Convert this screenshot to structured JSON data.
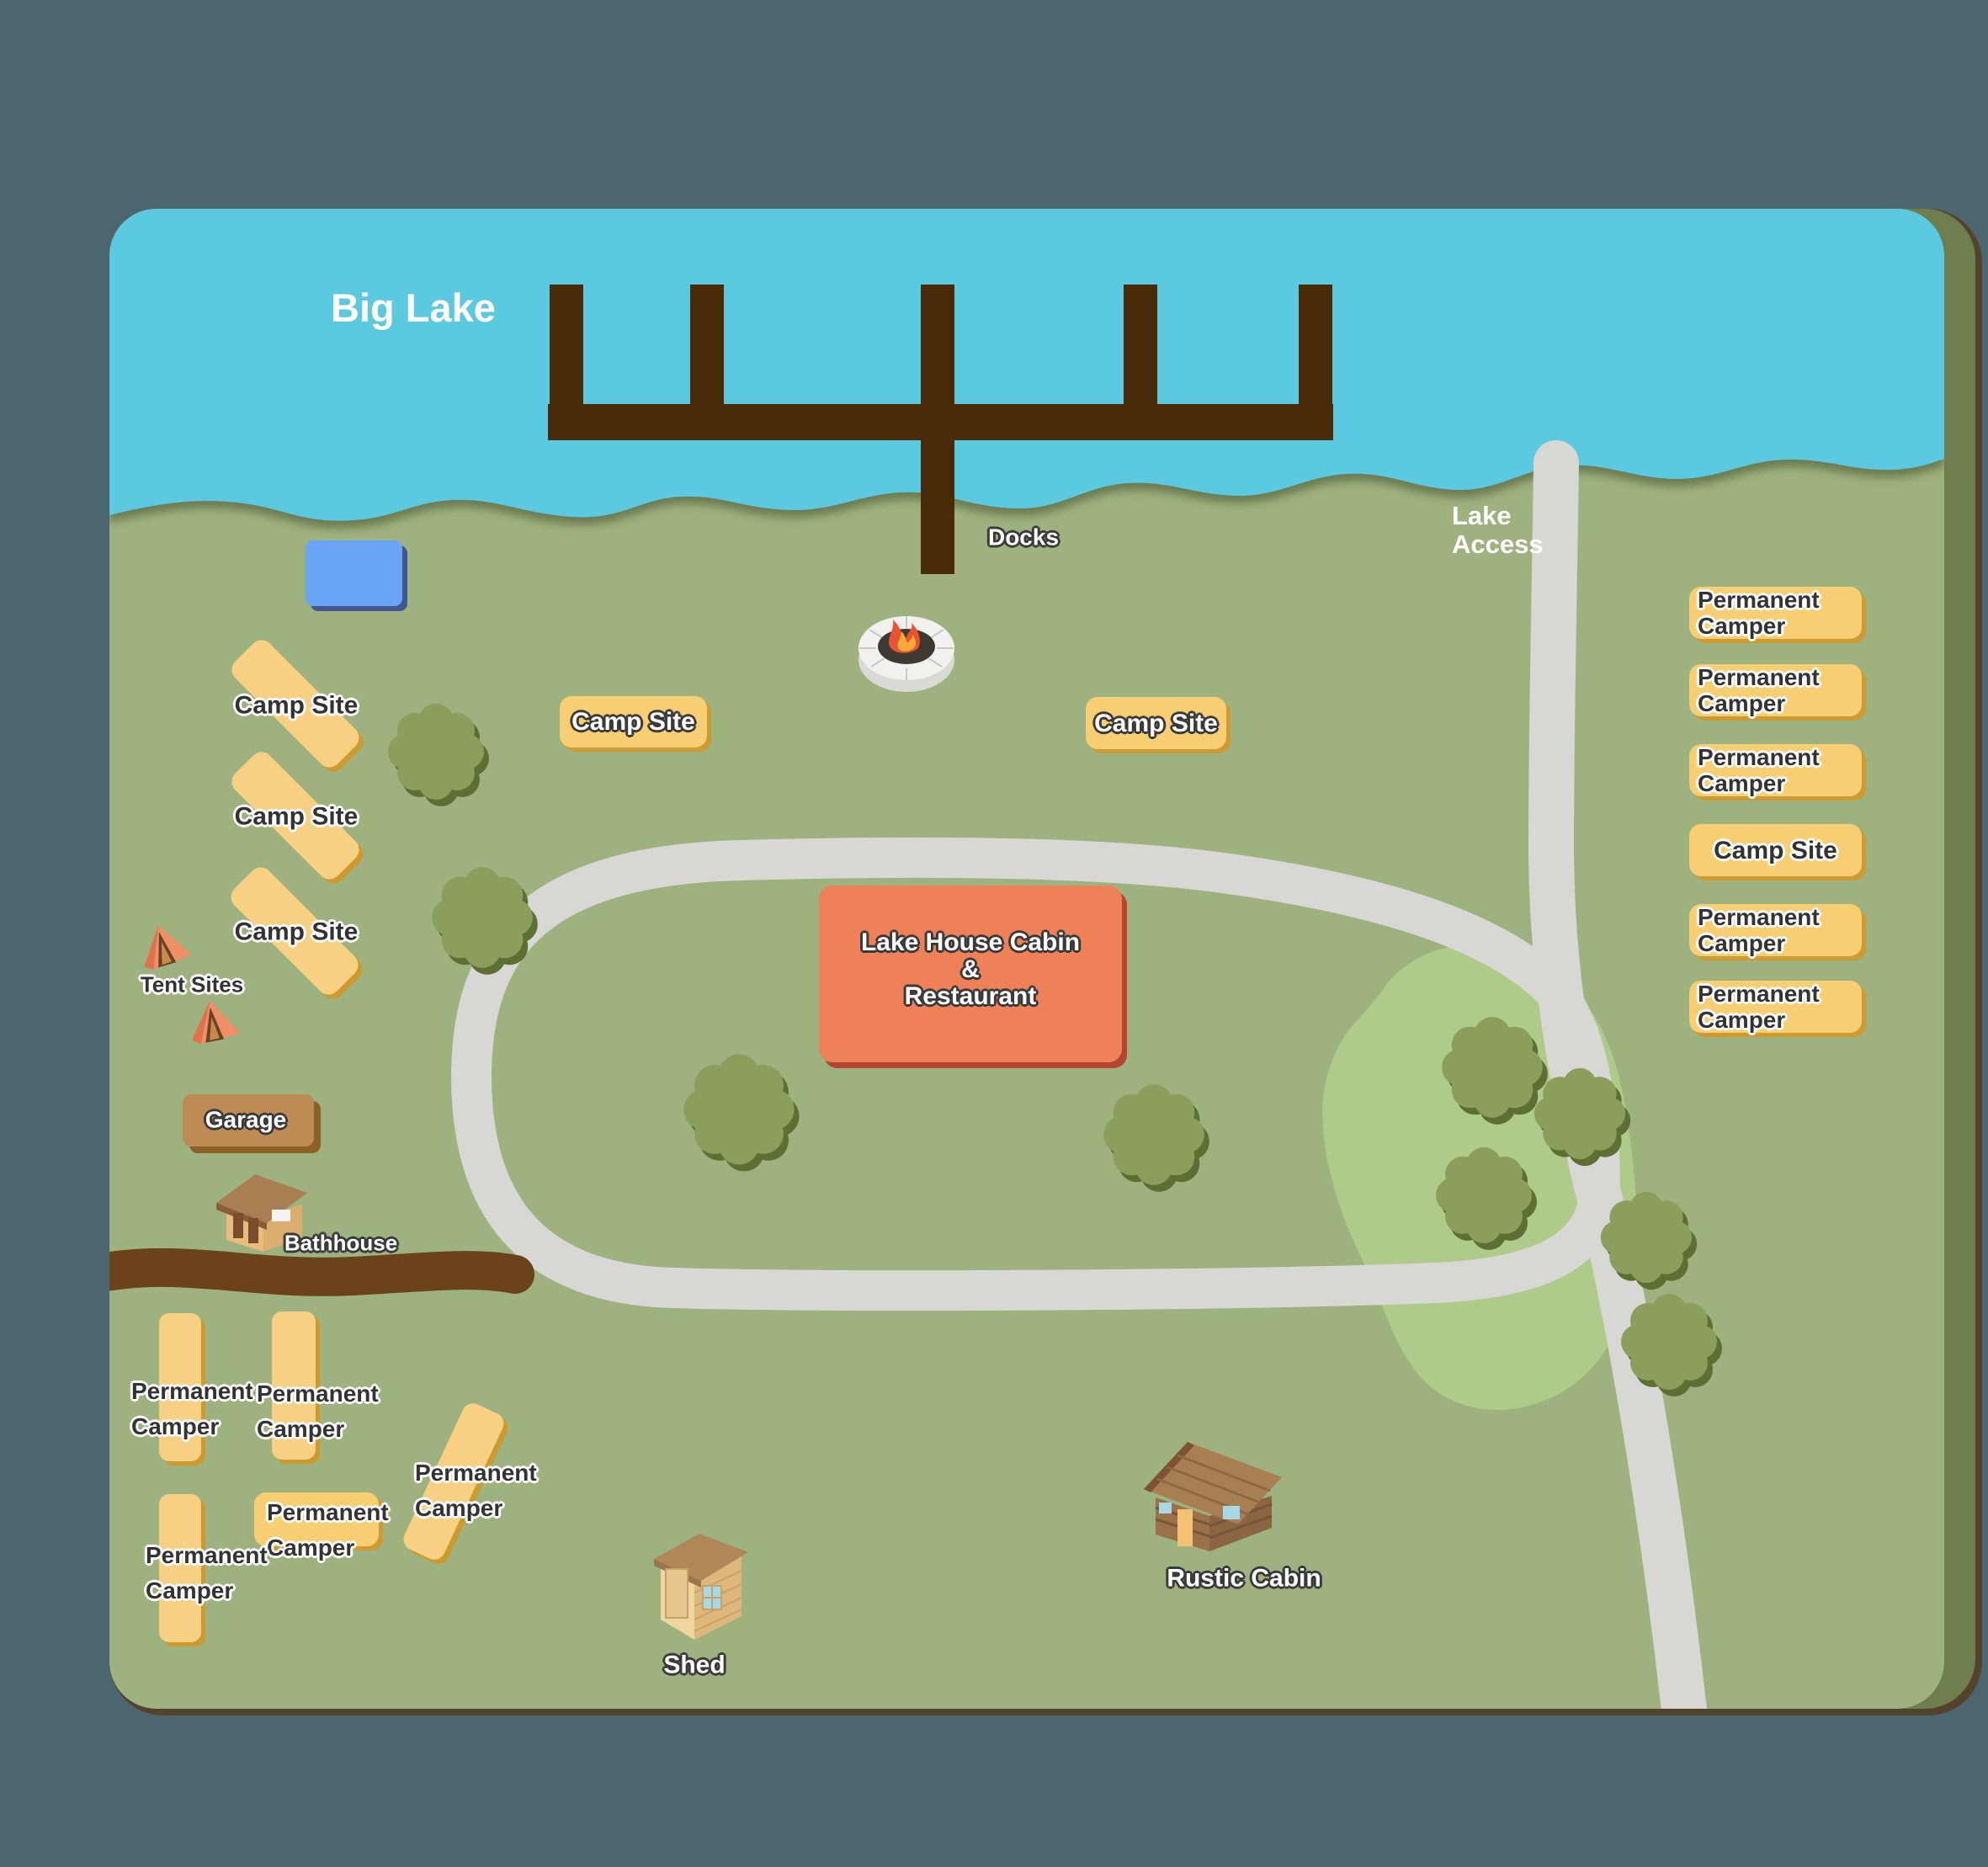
{
  "map_title": "Big Lake Campground Map",
  "lake": {
    "name": "Big Lake"
  },
  "docks_label": "Docks",
  "lake_access": {
    "line1": "Lake",
    "line2": "Access"
  },
  "left_camp_sites": [
    {
      "label": "Camp Site"
    },
    {
      "label": "Camp Site"
    },
    {
      "label": "Camp Site"
    }
  ],
  "camp_badges": {
    "left": "Camp Site",
    "right": "Camp Site"
  },
  "right_column": [
    {
      "line1": "Permanent",
      "line2": "Camper"
    },
    {
      "line1": "Permanent",
      "line2": "Camper"
    },
    {
      "line1": "Permanent",
      "line2": "Camper"
    },
    {
      "single": "Camp Site"
    },
    {
      "line1": "Permanent",
      "line2": "Camper"
    },
    {
      "line1": "Permanent",
      "line2": "Camper"
    }
  ],
  "tent_sites_label": "Tent Sites",
  "garage_label": "Garage",
  "bathhouse_label": "Bathhouse",
  "lake_house": {
    "line1": "Lake House Cabin",
    "line2": "&",
    "line3": "Restaurant"
  },
  "bottom_left": [
    {
      "line1": "Permanent",
      "line2": "Camper"
    },
    {
      "line1": "Permanent",
      "line2": "Camper"
    },
    {
      "line1": "Permanent",
      "line2": "Camper"
    },
    {
      "line1": "Permanent",
      "line2": "Camper"
    },
    {
      "line1": "Permanent",
      "line2": "Camper"
    }
  ],
  "rustic_cabin_label": "Rustic Cabin",
  "shed_label": "Shed",
  "colors": {
    "background": "#4C6670",
    "map_border_brown": "#54432B",
    "map_edge_olive": "#6F7E4E",
    "grass": "#9DB27E",
    "grass_light_patch": "#AECB8A",
    "lake": "#5BC9DF",
    "road": "#D7D7D4",
    "dirt_road": "#6B4219",
    "dock": "#4A2B09",
    "pad_yellow": "#F8D084",
    "pad_shadow": "#CD9A2F",
    "badge_yellow": "#F8CE73",
    "pond_blue": "#69A4F5",
    "pond_shadow": "#44568F",
    "lake_house_fill": "#EF8159",
    "lake_house_shadow": "#B5452E",
    "garage_fill": "#BE8B55",
    "bush_green": "#8B9E5C",
    "bush_shadow": "#5D7034",
    "tent_orange": "#EF8F66"
  }
}
